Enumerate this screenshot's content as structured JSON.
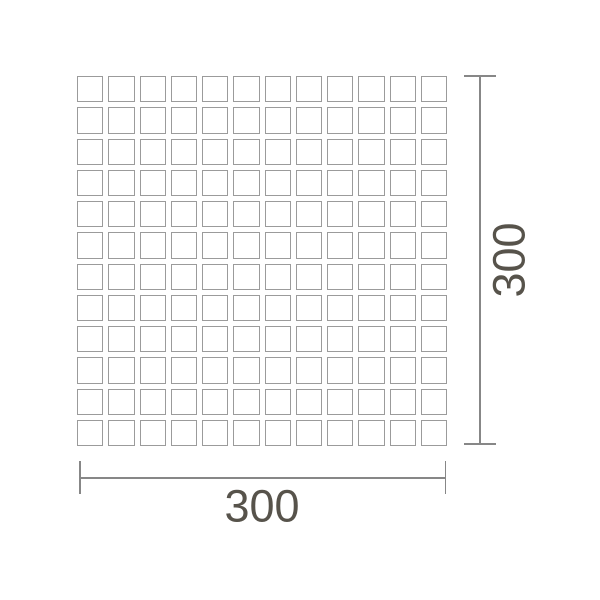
{
  "diagram": {
    "grid": {
      "rows": 12,
      "cols": 12
    },
    "dimensions": {
      "height_label": "300",
      "width_label": "300"
    },
    "colors": {
      "background": "#ffffff",
      "tile_border": "#9b9b9b",
      "dimension_line": "#878787",
      "label_text": "#57534b"
    }
  }
}
